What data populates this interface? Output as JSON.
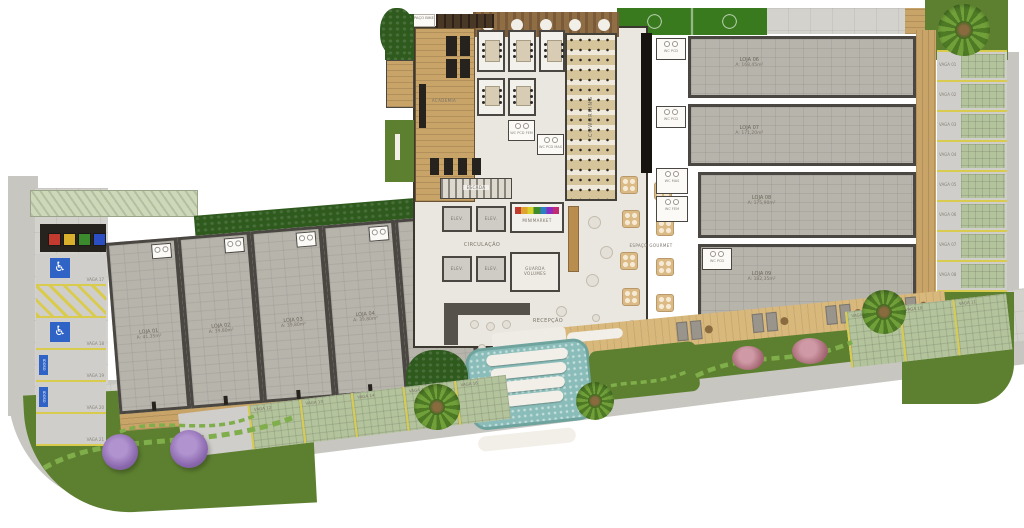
{
  "plan": {
    "amenities": {
      "espaco_bike": "ESPAÇO BIKE",
      "academia": "ACADEMIA",
      "coworking": "COWORKING",
      "escada": "ESCADA",
      "elevador": "ELEV.",
      "minimarket": "MINIMARKET",
      "circulacao": "CIRCULAÇÃO",
      "guarda_volumes_1": "GUARDA",
      "guarda_volumes_2": "VOLUMES",
      "recepcao": "RECEPÇÃO",
      "espaco_gourmet": "ESPAÇO GOURMET",
      "wc_pcd": "WC PCD",
      "wc_pcd_fem": "WC PCD FEM",
      "wc_pcd_mas": "WC PCD MAS",
      "wc_mas": "WC MAS",
      "wc_fem": "WC FEM"
    },
    "stores_left": [
      {
        "name": "LOJA 01",
        "area": "A: 41,35m²"
      },
      {
        "name": "LOJA 02",
        "area": "A: 39,80m²"
      },
      {
        "name": "LOJA 03",
        "area": "A: 39,80m²"
      },
      {
        "name": "LOJA 04",
        "area": "A: 39,80m²"
      },
      {
        "name": "LOJA 05",
        "area": "A: 41,10m²"
      }
    ],
    "units_right": [
      {
        "name": "LOJA 06",
        "area": "A: 168,45m²"
      },
      {
        "name": "LOJA 07",
        "area": "A: 171,20m²"
      },
      {
        "name": "LOJA 08",
        "area": "A: 175,90m²"
      },
      {
        "name": "LOJA 09",
        "area": "A: 182,35m²"
      }
    ],
    "parking_left": [
      {
        "label": "VAGA 17",
        "type": "pcd",
        "tag": ""
      },
      {
        "label": "",
        "type": "hatch",
        "tag": ""
      },
      {
        "label": "VAGA 18",
        "type": "pcd",
        "tag": ""
      },
      {
        "label": "VAGA 19",
        "type": "idoso",
        "tag": "IDOSO"
      },
      {
        "label": "VAGA 20",
        "type": "idoso",
        "tag": "IDOSO"
      },
      {
        "label": "VAGA 21",
        "type": "plain",
        "tag": ""
      }
    ],
    "parking_bottom": [
      "VAGA 12",
      "VAGA 13",
      "VAGA 14",
      "VAGA 15",
      "VAGA 16"
    ],
    "parking_right": [
      "VAGA 01",
      "VAGA 02",
      "VAGA 03",
      "VAGA 04",
      "VAGA 05",
      "VAGA 06",
      "VAGA 07",
      "VAGA 08"
    ],
    "parking_diag": [
      "VAGA 09",
      "VAGA 10",
      "VAGA 11"
    ]
  }
}
